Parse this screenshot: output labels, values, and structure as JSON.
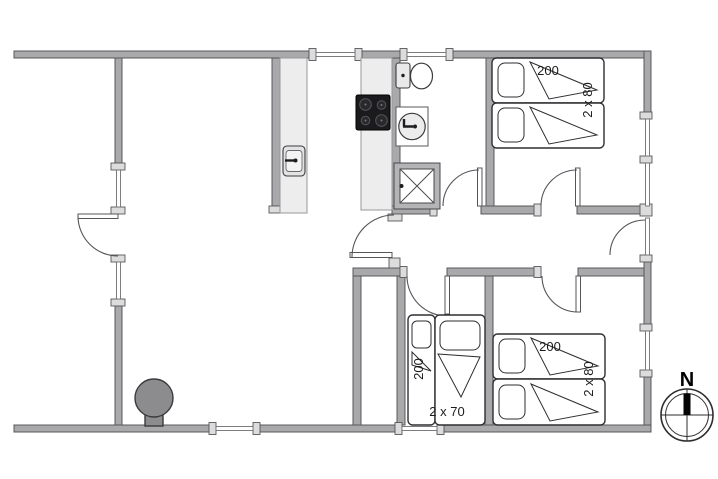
{
  "compass": {
    "north_label": "N"
  },
  "bedrooms": {
    "top_right": {
      "bed_length": "200",
      "bed_width": "2 x 80"
    },
    "bottom_center": {
      "bed_length": "200",
      "bed_width": "2 x 70"
    },
    "bottom_right": {
      "bed_length": "200",
      "bed_width": "2 x 80"
    }
  },
  "colors": {
    "wall_fill": "#a9a9ab",
    "wall_edge": "#58585b",
    "counter_fill": "#ededee",
    "cooktop_fill": "#1b1b1d",
    "stove_fill": "#8c8c8e",
    "line": "#2e2e31"
  }
}
